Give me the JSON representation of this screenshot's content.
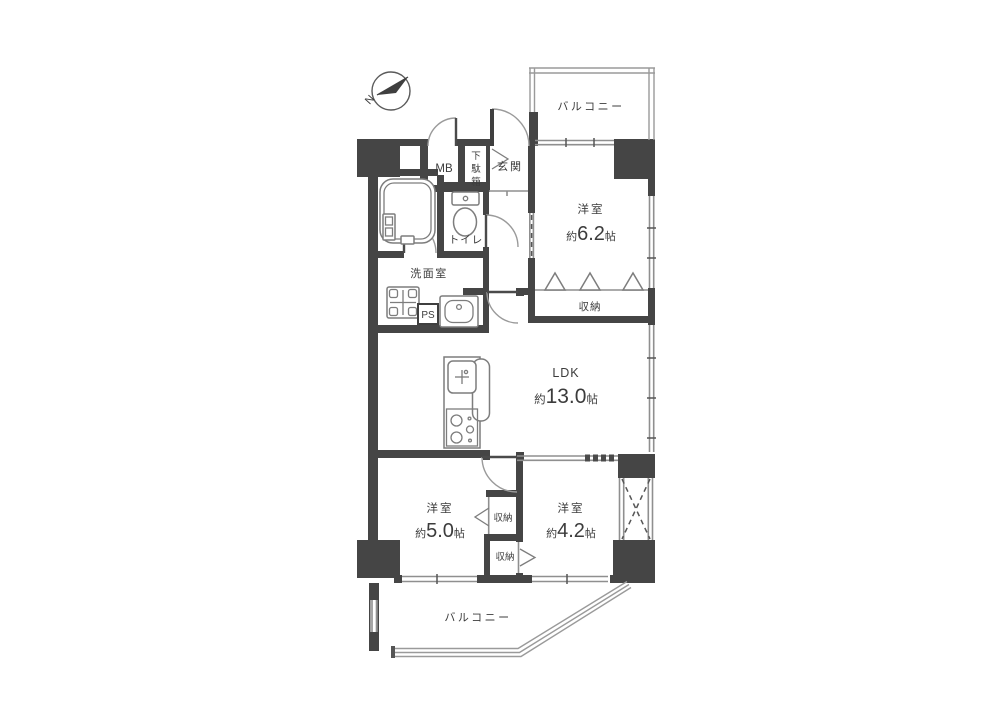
{
  "floor_plan": {
    "compass": {
      "label": "N"
    },
    "balcony_top": {
      "label": "バルコニー"
    },
    "balcony_bottom": {
      "label": "バルコニー"
    },
    "meter_box": {
      "label": "MB"
    },
    "shoe_cabinet": {
      "chars": [
        "下",
        "駄",
        "箱"
      ]
    },
    "entrance": {
      "label": "玄関"
    },
    "toilet": {
      "label": "トイレ"
    },
    "washroom": {
      "label": "洗面室"
    },
    "pipe_space": {
      "label": "PS"
    },
    "bedroom_6_2": {
      "label": "洋室",
      "size_prefix": "約",
      "size_value": "6.2",
      "size_unit": "帖"
    },
    "closet_bedroom_6_2": {
      "label": "収納"
    },
    "ldk": {
      "label": "LDK",
      "size_prefix": "約",
      "size_value": "13.0",
      "size_unit": "帖"
    },
    "bedroom_5_0": {
      "label": "洋室",
      "size_prefix": "約",
      "size_value": "5.0",
      "size_unit": "帖"
    },
    "closet_upper": {
      "label": "収納"
    },
    "closet_lower": {
      "label": "収納"
    },
    "bedroom_4_2": {
      "label": "洋室",
      "size_prefix": "約",
      "size_value": "4.2",
      "size_unit": "帖"
    }
  },
  "colors": {
    "wall": "#454545",
    "window_line": "#8f8f8f",
    "railing": "#9a9a9a",
    "text": "#3c3c3c",
    "background": "#ffffff"
  }
}
